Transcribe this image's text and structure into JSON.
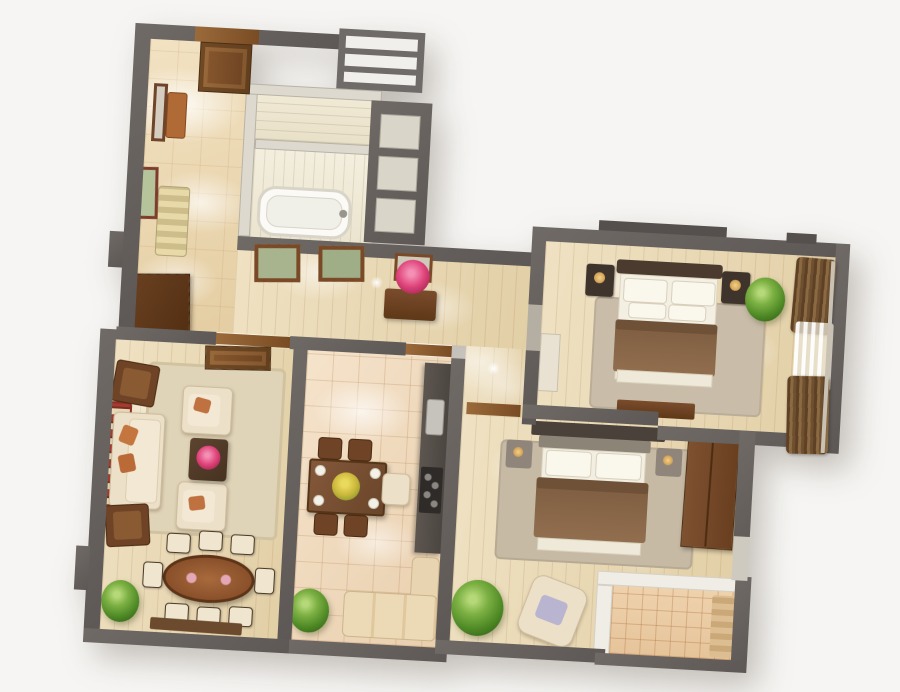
{
  "meta": {
    "description": "3D rendered top-down floor plan of a three-room apartment with full furniture, viewed from above on a white background",
    "background": "#f6f5f3"
  },
  "palette": {
    "outer_wall": "#66615d",
    "partition": "#ddd9ce",
    "white_parapet": "#f0ede7",
    "marble_floor": "#efdfbe",
    "wood_floor": "#e9d8b4",
    "kitchen_tile": "#f2ddc2",
    "balcony_tile": "#ecd0ab",
    "rug_beige": "#e0d4b8",
    "rug_gray": "#c9bda9",
    "bed_blanket": "#8b684a",
    "linen_white": "#f3efe2",
    "dark_wood": "#6e4226",
    "wardrobe_wood": "#74492a",
    "cream_upholstery": "#ece0c8",
    "counter_dark": "#57504a",
    "door_brown": "#7a4c28",
    "plant_green": "#5f9a2e",
    "flower_pink": "#e0457b",
    "flower_yellow": "#d8c23c"
  },
  "rooms": {
    "hallway": {
      "label": "Entrance hallway",
      "floor": "beige marble tile",
      "furniture": [
        "entrance door",
        "wall mirror with console",
        "striped bench",
        "wardrobe cabinet",
        "framed picture"
      ]
    },
    "wc": {
      "label": "WC",
      "floor": "cream tile",
      "furniture": []
    },
    "bathroom": {
      "label": "Bathroom",
      "floor": "cream tile",
      "furniture": [
        "bathtub"
      ]
    },
    "corridor": {
      "label": "Corridor",
      "floor": "light oak planks",
      "furniture": [
        "two framed pictures",
        "console table with mirror and pink flowers"
      ]
    },
    "living_room": {
      "label": "Living room",
      "floor": "light oak planks",
      "furniture": [
        "cream sofa with orange pillows",
        "two cream armchairs",
        "dark coffee table with pink flowers",
        "two wooden side chairs",
        "patterned runner rug",
        "large beige area rug"
      ]
    },
    "dining_area": {
      "label": "Dining area",
      "floor": "light oak planks",
      "furniture": [
        "oval inlaid dining table",
        "eight cream chairs",
        "potted plant",
        "window sill shelf"
      ]
    },
    "kitchen": {
      "label": "Kitchen",
      "floor": "beige marble tile",
      "furniture": [
        "dining table with yellow flowers and four chairs",
        "dark counter with sink and hob",
        "L-shaped cream bench",
        "potted plant"
      ]
    },
    "bedroom_1": {
      "label": "Master bedroom",
      "floor": "light oak planks",
      "furniture": [
        "double bed with brown blanket",
        "two dark nightstands with lamps",
        "dresser",
        "white cabinet",
        "potted plant",
        "brown curtains with white sheer",
        "gray rug"
      ]
    },
    "bedroom_2": {
      "label": "Second bedroom",
      "floor": "light oak planks",
      "furniture": [
        "double bed with brown blanket",
        "two nightstands",
        "brown wardrobe",
        "cream armchair with lavender pillow",
        "potted plant",
        "gray rug"
      ]
    },
    "balcony": {
      "label": "Balcony",
      "floor": "terracotta tile",
      "furniture": [
        "rolled mat"
      ]
    }
  }
}
